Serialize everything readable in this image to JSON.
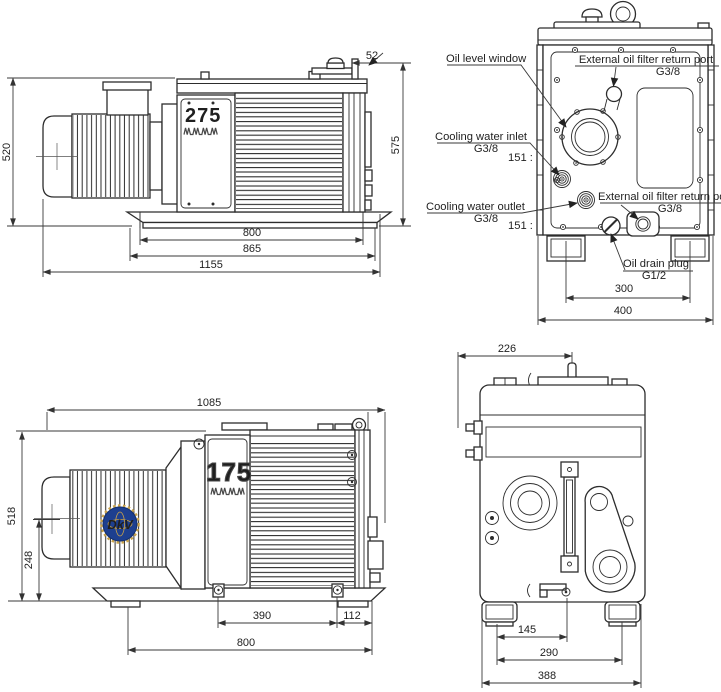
{
  "views": {
    "side_275": {
      "model": "275",
      "dims": {
        "height_to_rail": "520",
        "height_overall": "575",
        "port_offset": "52",
        "bolt_span": "800",
        "base_width": "865",
        "overall_length": "1155"
      }
    },
    "rear": {
      "labels": {
        "oil_level_window": "Oil level window",
        "filter_return_port": "External oil filter return port",
        "filter_return_port_size": "G3/8",
        "water_inlet": "Cooling water inlet",
        "water_inlet_size": "G3/8",
        "water_inlet_note": "151 :",
        "water_outlet": "Cooling water outlet",
        "water_outlet_size": "G3/8",
        "water_outlet_note": "151 :",
        "filter_return": "External oil filter return port",
        "filter_return_size": "G3/8",
        "oil_drain": "Oil drain plug",
        "oil_drain_size": "G1/2"
      },
      "dims": {
        "foot_span": "300",
        "overall_width": "400"
      }
    },
    "side_175": {
      "model": "175",
      "logo": "DkV",
      "dims": {
        "overall_length": "1085",
        "height_overall": "518",
        "shaft_height": "248",
        "bolt_span": "390",
        "bolt_to_edge": "112",
        "base_span": "800"
      }
    },
    "front": {
      "dims": {
        "port_offset": "226",
        "drain_offset": "145",
        "foot_span": "290",
        "overall_width": "388"
      }
    }
  }
}
